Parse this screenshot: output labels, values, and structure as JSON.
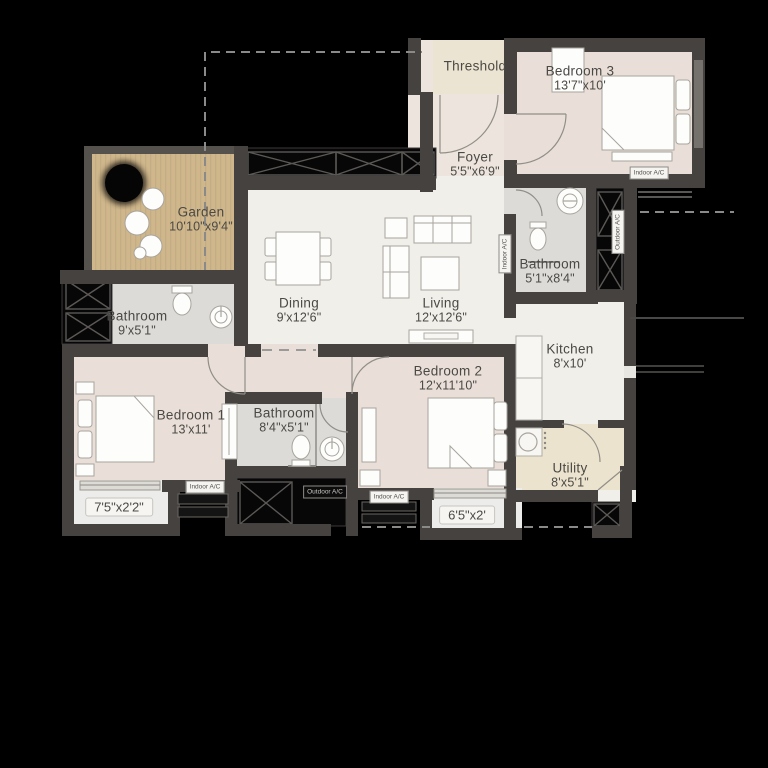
{
  "rooms": {
    "garden": {
      "name": "Garden",
      "dims": "10'10\"x9'4\""
    },
    "threshold": {
      "name": "Threshold",
      "dims": ""
    },
    "bedroom3": {
      "name": "Bedroom 3",
      "dims": "13'7\"x10'"
    },
    "foyer": {
      "name": "Foyer",
      "dims": "5'5\"x6'9\""
    },
    "bathroom_top": {
      "name": "Bathroom",
      "dims": "5'1\"x8'4\""
    },
    "dining": {
      "name": "Dining",
      "dims": "9'x12'6\""
    },
    "living": {
      "name": "Living",
      "dims": "12'x12'6\""
    },
    "kitchen": {
      "name": "Kitchen",
      "dims": "8'x10'"
    },
    "utility": {
      "name": "Utility",
      "dims": "8'x5'1\""
    },
    "bathroom_left": {
      "name": "Bathroom",
      "dims": "9'x5'1\""
    },
    "bedroom1": {
      "name": "Bedroom 1",
      "dims": "13'x11'"
    },
    "bathroom_mid": {
      "name": "Bathroom",
      "dims": "8'4\"x5'1\""
    },
    "bedroom2": {
      "name": "Bedroom 2",
      "dims": "12'x11'10\""
    },
    "balcony1": {
      "dims": "7'5\"x2'2\""
    },
    "balcony2": {
      "dims": "6'5\"x2'"
    }
  },
  "ac_labels": {
    "indoor": "Indoor A/C",
    "outdoor": "Outdoor A/C"
  },
  "colors": {
    "background": "#000000",
    "wall": "#454240",
    "bedroom_floor": "#e9dfd8",
    "living_floor": "#f1efe9",
    "bathroom_floor": "#dcdbd7",
    "garden_floor": "#cfb68b",
    "utility_floor": "#ebe3cd",
    "threshold_floor": "#ebe4d2"
  }
}
